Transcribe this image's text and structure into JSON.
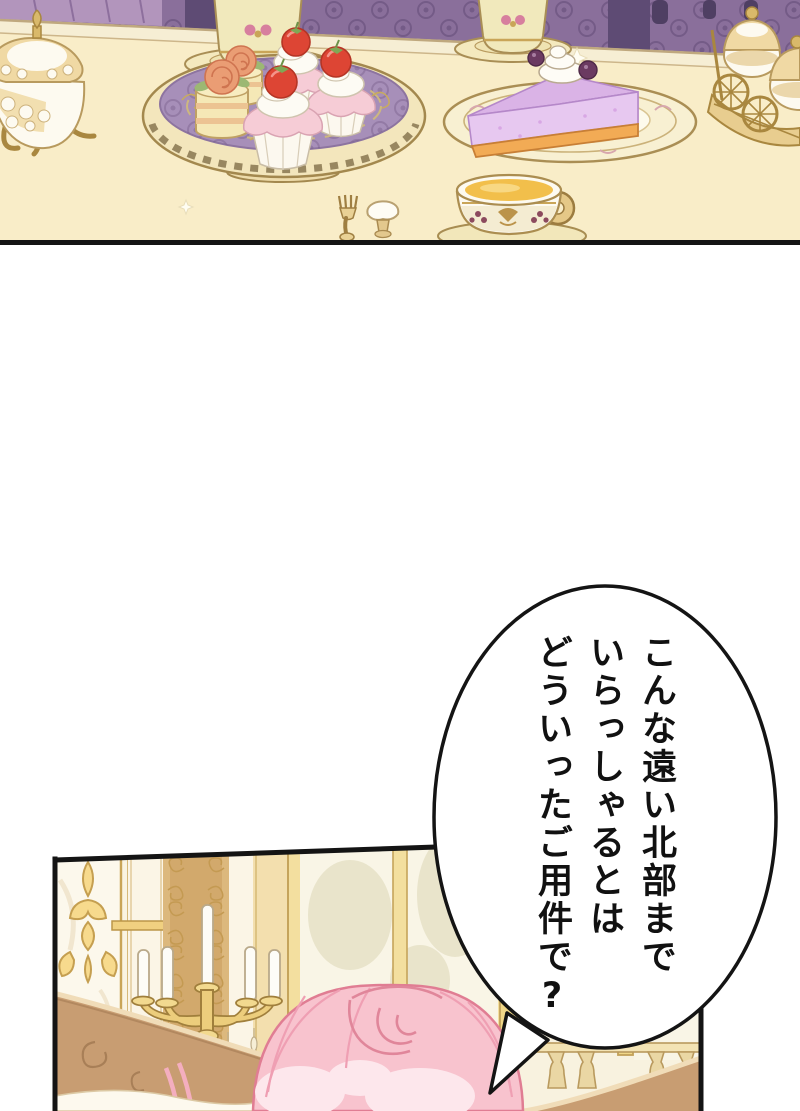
{
  "page": {
    "kind": "manhwa-episode-page",
    "background": "#ffffff",
    "width": 800,
    "height": 1111
  },
  "speech_bubble": {
    "shape": "ellipse-with-tail",
    "fill": "#ffffff",
    "stroke": "#141414",
    "writing": "vertical-japanese",
    "lines": [
      "こんな遠い北部まで",
      "いらっしゃるとは",
      "どういったご用件で?"
    ]
  },
  "top_panel": {
    "scene": "tea-table-with-desserts",
    "objects": {
      "wallpaper": "purple-damask-wallpaper",
      "tureen": "porcelain-tureen-on-gold-stand",
      "dessert_platter": "purple-gold-platter",
      "platter_items": [
        "rose-petit-four",
        "rose-petit-four",
        "strawberry-cupcake",
        "strawberry-cupcake",
        "strawberry-cupcake"
      ],
      "teacups_back": 2,
      "cheesecake_plate": "berry-cheesecake-slice-with-cream",
      "teacup_front": "teacup-filled-with-tea",
      "dessert_cart": "gilded-cart-with-covered-tureens",
      "cutlery": [
        "dessert-fork",
        "meringue-puff"
      ]
    },
    "palette": {
      "tabletop": "#f9edc8",
      "wallpaper_purple": "#8a6f9b",
      "wallpaper_dark": "#5e4b74",
      "drape": "#b295bc",
      "porcelain": "#f1e9bc",
      "gold": "#c9a558",
      "platter_purple": "#a78fb9",
      "frosting_pink": "#f6ccd6",
      "strawberry_red": "#dd4534",
      "cheesecake_lavender": "#dab3e6",
      "crust_orange": "#f2ab55",
      "tea": "#f2bf4b",
      "panel_border": "#141414"
    }
  },
  "bottom_panel": {
    "scene": "palace-room-with-pink-haired-character",
    "objects": {
      "wall_panel": "gold-rococo-ornament-panel",
      "wallpaper_strip": "tan-damask-wallpaper",
      "candelabra": "gold-candelabra-with-white-candles",
      "window": "gold-framed-window",
      "balustrade": "railing-with-balusters",
      "sofa": "tan-sofa-back",
      "character": "pink-haired-character-seen-from-behind"
    },
    "palette": {
      "wall": "#faf4e2",
      "wall_tan": "#dcb87d",
      "gold": "#c9a558",
      "candle": "#fdfcf7",
      "sofa": "#c89d72",
      "hair_pink": "#f8c3ce",
      "hair_outline": "#e07d93",
      "glass": "#f9f5e6",
      "panel_border": "#141414"
    }
  }
}
